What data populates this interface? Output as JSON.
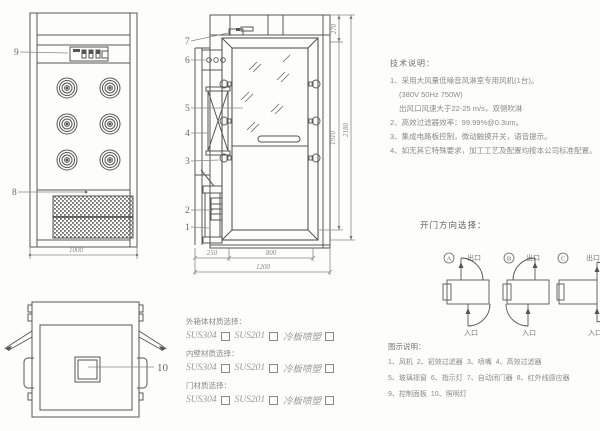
{
  "views": {
    "front": {
      "dim_width": "1000",
      "callout_9": "9",
      "callout_8": "8"
    },
    "side": {
      "callouts": {
        "c1": "1",
        "c2": "2",
        "c3": "3",
        "c4": "4",
        "c5": "5",
        "c6": "6",
        "c7": "7"
      },
      "dims": {
        "d250": "250",
        "d800": "800",
        "d1200": "1200",
        "d270": "270",
        "d1910": "1910",
        "d2180": "2180"
      }
    },
    "top": {
      "callout_10": "10"
    }
  },
  "tech_notes": {
    "title": "技术说明：",
    "lines": [
      "1、采用大风量低噪音风淋室专用风机(1台)。",
      "(380V 50Hz  750W)",
      "出风口风速大于22-25 m/s，双侧吹淋",
      "2、高效过滤器效率：99.99%@0.3um。",
      "3、集成电路板控制，微动触摸开关，语音提示。",
      "4、如无其它特殊要求，加工工艺及配置均按本公司标准配置。"
    ]
  },
  "door_direction": {
    "title": "开门方向选择：",
    "options": [
      {
        "id": "A",
        "exit": "出口",
        "entry": "入口"
      },
      {
        "id": "B",
        "exit": "出口",
        "entry": "入口"
      },
      {
        "id": "C",
        "exit": "出口",
        "entry": "入口"
      }
    ]
  },
  "materials": {
    "sections": [
      {
        "title": "外箱体材质选择：",
        "options": [
          "SUS304",
          "SUS201",
          "冷板喷塑"
        ]
      },
      {
        "title": "内壁材质选择：",
        "options": [
          "SUS304",
          "SUS201",
          "冷板喷塑"
        ]
      },
      {
        "title": "门材质选择：",
        "options": [
          "SUS304",
          "SUS201",
          "冷板喷塑"
        ]
      }
    ]
  },
  "legend": {
    "title": "图示说明：",
    "items": [
      "1、风机",
      "2、初效过滤器",
      "3、喷嘴",
      "4、高效过滤器",
      "5、玻璃视窗",
      "6、指示灯",
      "7、自动闭门器",
      "8、红外线感应器",
      "9、控制面板",
      "10、照明灯"
    ]
  },
  "colors": {
    "line": "#565656",
    "text": "#8a8a8a"
  }
}
